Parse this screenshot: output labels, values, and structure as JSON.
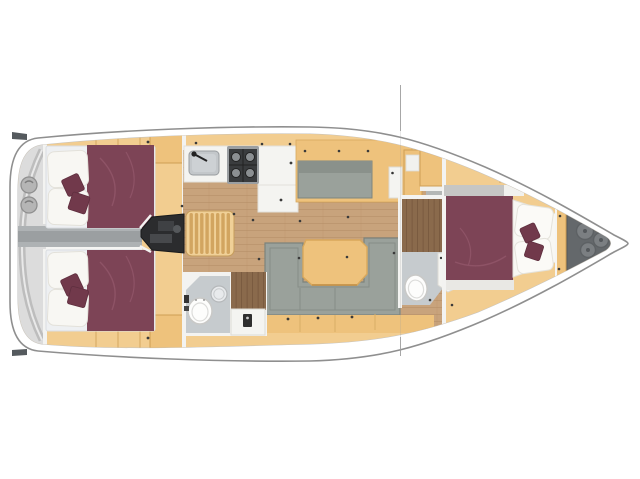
{
  "image": {
    "title": "Sailing yacht interior layout plan, top view, bow to the right",
    "type": "floor-plan"
  },
  "colors": {
    "background": "#ffffff",
    "hull_fill": "#ffffff",
    "hull_outline": "#8f8f8f",
    "hull_inner_line": "#c2c2c2",
    "interior_tan": "#f2cd90",
    "furniture_tan": "#eec27c",
    "furniture_tan_dark": "#e2ad5f",
    "wood_floor": "#c8a37c",
    "dark_teak": "#8a6a4c",
    "stair_wood": "#f0d097",
    "stair_slat": "#d2a560",
    "mattress_maroon": "#7d4456",
    "cushion_maroon": "#71394b",
    "pillow_white": "#f8f7f3",
    "bed_platform": "#eef0f2",
    "upholstery_gray": "#9aa19b",
    "upholstery_gray_dark": "#8a918b",
    "engine_dark": "#2b2c2e",
    "corridor_gray": "#aeb2b4",
    "wet_room_gray": "#c6cbce",
    "fixture_white": "#f4f4f1",
    "toilet_white": "#fdfdfc",
    "stove_dark": "#3a3c3e",
    "sink_gray": "#c3c7ca",
    "anchor_locker_gray": "#64686b",
    "anchor_hatch_gray": "#7b7f82",
    "stern_platform_gray": "#dcdcdc",
    "stern_winch_gray": "#b5b5b5",
    "wall_white": "#f3f3f1",
    "mast_line_gray": "#9e9e9e",
    "fitting_dot_dark": "#3a3a3a"
  },
  "areas": {
    "stern_platform": {
      "name": "stern swim platform",
      "features": [
        "transom",
        "two round deck fittings"
      ]
    },
    "aft_cabin_port": {
      "name": "aft cabin port",
      "features": [
        "double berth",
        "two pillows",
        "two decorative cushions",
        "wardrobe",
        "lockers"
      ]
    },
    "aft_cabin_starboard": {
      "name": "aft cabin starboard",
      "features": [
        "double berth",
        "two pillows",
        "two decorative cushions",
        "wardrobe",
        "lockers"
      ]
    },
    "engine_compartment": {
      "name": "engine compartment",
      "features": [
        "engine block",
        "access corridor"
      ]
    },
    "companionway": {
      "name": "companionway",
      "features": [
        "entry stairs"
      ]
    },
    "galley": {
      "name": "galley",
      "features": [
        "sink with faucet",
        "four-burner stove",
        "refrigerator counter"
      ]
    },
    "salon": {
      "name": "salon",
      "features": [
        "u-shaped sofa",
        "dining table",
        "starboard settee",
        "tall cabinet",
        "wood plank floor"
      ]
    },
    "aft_head": {
      "name": "aft head",
      "features": [
        "toilet",
        "round washbasin",
        "teak shower floor",
        "shower column"
      ]
    },
    "forward_head": {
      "name": "forward head",
      "features": [
        "toilet",
        "vanity unit",
        "teak floor"
      ]
    },
    "forward_cabin": {
      "name": "forward cabin",
      "features": [
        "double berth",
        "two pillows",
        "two decorative cushions",
        "wardrobe"
      ]
    },
    "anchor_locker": {
      "name": "bow anchor locker",
      "features": [
        "three round hatches"
      ]
    },
    "rig": {
      "name": "mast section line",
      "features": [
        "thin vertical line across hull"
      ]
    }
  },
  "counts": {
    "cabins": 3,
    "heads": 2,
    "berths": 3,
    "stern_fittings": 2,
    "anchor_hatches": 3
  }
}
